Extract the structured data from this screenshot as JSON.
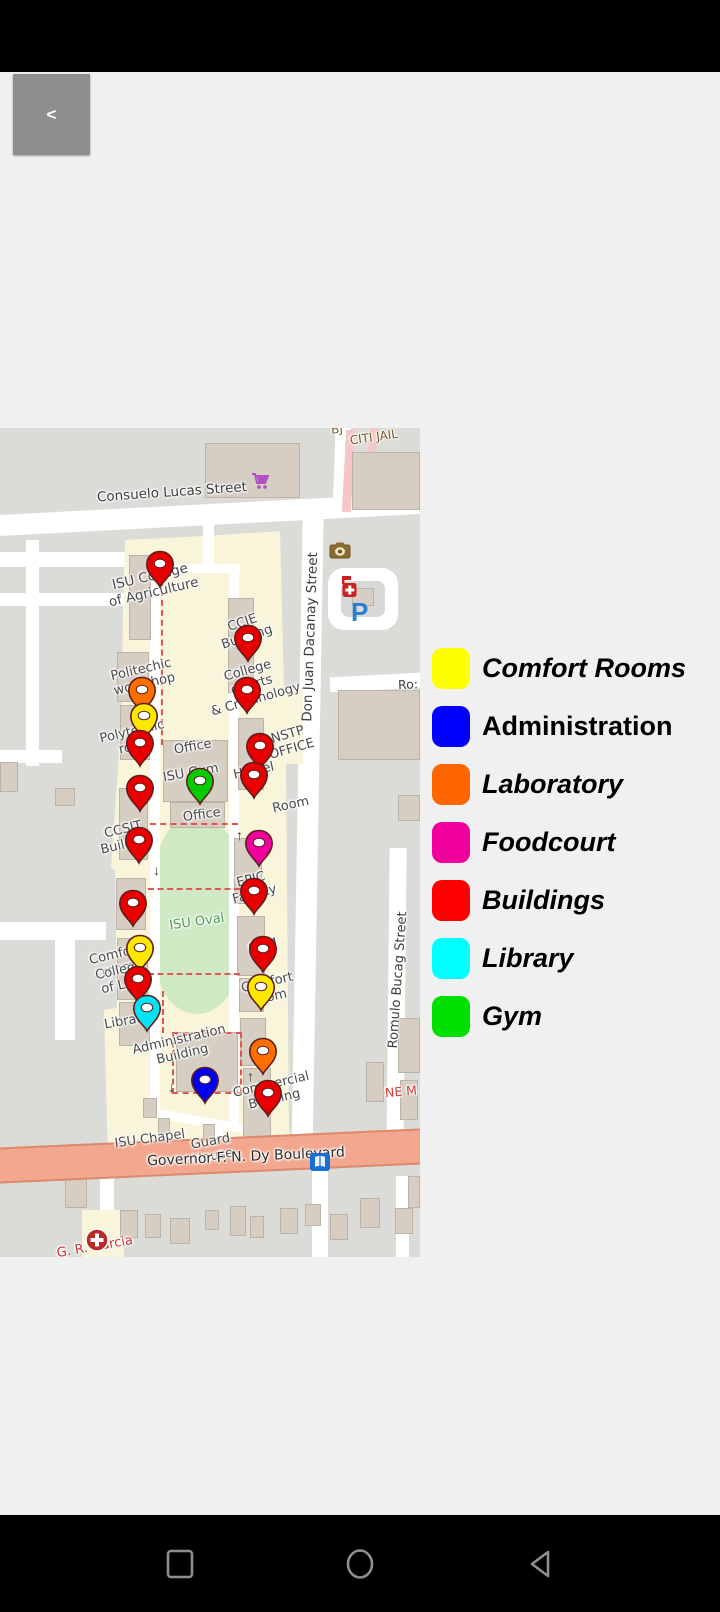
{
  "back_button": {
    "label": "<"
  },
  "legend": {
    "items": [
      {
        "label": "Comfort Rooms",
        "color": "#FFFF00",
        "italic": true,
        "category": "comfort-rooms"
      },
      {
        "label": "Administration",
        "color": "#0000FF",
        "italic": false,
        "category": "administration"
      },
      {
        "label": "Laboratory",
        "color": "#FF6600",
        "italic": true,
        "category": "laboratory"
      },
      {
        "label": "Foodcourt",
        "color": "#F0009C",
        "italic": true,
        "category": "foodcourt"
      },
      {
        "label": "Buildings",
        "color": "#FF0000",
        "italic": true,
        "category": "buildings"
      },
      {
        "label": "Library",
        "color": "#00FFFF",
        "italic": true,
        "category": "library"
      },
      {
        "label": "Gym",
        "color": "#00E000",
        "italic": true,
        "category": "gym"
      }
    ]
  },
  "map": {
    "marker_colors": {
      "building": "#E80000",
      "laboratory": "#FF6F00",
      "comfort-room": "#FFE800",
      "gym": "#00CC00",
      "library": "#00E5F5",
      "administration": "#0000F0",
      "foodcourt": "#F0009C"
    },
    "markers": [
      {
        "category": "building",
        "x": 160,
        "y": 138
      },
      {
        "category": "building",
        "x": 248,
        "y": 212
      },
      {
        "category": "building",
        "x": 247,
        "y": 264
      },
      {
        "category": "laboratory",
        "x": 142,
        "y": 264
      },
      {
        "category": "comfort-room",
        "x": 144,
        "y": 290
      },
      {
        "category": "building",
        "x": 140,
        "y": 317
      },
      {
        "category": "building",
        "x": 260,
        "y": 320
      },
      {
        "category": "building",
        "x": 254,
        "y": 349
      },
      {
        "category": "gym",
        "x": 200,
        "y": 355
      },
      {
        "category": "building",
        "x": 140,
        "y": 362
      },
      {
        "category": "building",
        "x": 139,
        "y": 414
      },
      {
        "category": "foodcourt",
        "x": 259,
        "y": 417
      },
      {
        "category": "building",
        "x": 254,
        "y": 465
      },
      {
        "category": "building",
        "x": 133,
        "y": 477
      },
      {
        "category": "comfort-room",
        "x": 140,
        "y": 522
      },
      {
        "category": "building",
        "x": 263,
        "y": 523
      },
      {
        "category": "building",
        "x": 138,
        "y": 553
      },
      {
        "category": "comfort-room",
        "x": 261,
        "y": 561
      },
      {
        "category": "library",
        "x": 147,
        "y": 582
      },
      {
        "category": "laboratory",
        "x": 263,
        "y": 625
      },
      {
        "category": "administration",
        "x": 205,
        "y": 654
      },
      {
        "category": "building",
        "x": 268,
        "y": 667
      }
    ],
    "labels": [
      {
        "id": "consuelo-lucas-street",
        "lines": [
          "Consuelo Lucas Street"
        ],
        "x": 172,
        "y": 65,
        "rot": -4,
        "size": 13.5,
        "color": "#3e3e3e"
      },
      {
        "id": "bj",
        "lines": [
          "BJ"
        ],
        "x": 337,
        "y": 2,
        "rot": -8,
        "size": 12,
        "color": "#7a5a28"
      },
      {
        "id": "citi-jail",
        "lines": [
          "CITI JAIL"
        ],
        "x": 374,
        "y": 10,
        "rot": -8,
        "size": 12,
        "color": "#7a5a28"
      },
      {
        "id": "don-juan-dacanay-street",
        "lines": [
          "Don Juan Dacanay Street"
        ],
        "x": 311,
        "y": 209,
        "rot": -88,
        "size": 13.5,
        "color": "#3e3e3e"
      },
      {
        "id": "ro",
        "lines": [
          "Ro:"
        ],
        "x": 408,
        "y": 257,
        "rot": -3,
        "size": 12.5,
        "color": "#3e3e3e"
      },
      {
        "id": "isu-college-of-agriculture",
        "lines": [
          "ISU College",
          "of Agriculture"
        ],
        "x": 152,
        "y": 157,
        "rot": -13,
        "size": 13.5,
        "color": "#4a4a4a"
      },
      {
        "id": "ccie-building",
        "lines": [
          "CCIE",
          "Building"
        ],
        "x": 245,
        "y": 203,
        "rot": -18,
        "size": 13,
        "color": "#4a4a4a"
      },
      {
        "id": "politechic-workshop",
        "lines": [
          "Politechic",
          "workshop"
        ],
        "x": 143,
        "y": 250,
        "rot": -13,
        "size": 13,
        "color": "#4a4a4a"
      },
      {
        "id": "polytechic-room",
        "lines": [
          "Polytechic",
          "room"
        ],
        "x": 134,
        "y": 312,
        "rot": -13,
        "size": 13,
        "color": "#4a4a4a"
      },
      {
        "id": "college-of-arts-criminology",
        "lines": [
          "College",
          "of Arts",
          "& Criminology"
        ],
        "x": 252,
        "y": 258,
        "rot": -16,
        "size": 13,
        "color": "#4a4a4a"
      },
      {
        "id": "nstp-office",
        "lines": [
          "NSTP",
          "OFFICE"
        ],
        "x": 290,
        "y": 315,
        "rot": -16,
        "size": 13,
        "color": "#4a4a4a"
      },
      {
        "id": "office-1",
        "lines": [
          "Office"
        ],
        "x": 193,
        "y": 320,
        "rot": -10,
        "size": 13,
        "color": "#4a4a4a"
      },
      {
        "id": "isu-gym",
        "lines": [
          "ISU Gym"
        ],
        "x": 191,
        "y": 346,
        "rot": -10,
        "size": 13,
        "color": "#4a4a4a"
      },
      {
        "id": "hostel",
        "lines": [
          "Hostel"
        ],
        "x": 254,
        "y": 344,
        "rot": -12,
        "size": 13,
        "color": "#4a4a4a"
      },
      {
        "id": "office-2",
        "lines": [
          "Office"
        ],
        "x": 202,
        "y": 388,
        "rot": -8,
        "size": 13,
        "color": "#4a4a4a"
      },
      {
        "id": "room",
        "lines": [
          "Room"
        ],
        "x": 291,
        "y": 378,
        "rot": -12,
        "size": 13,
        "color": "#4a4a4a"
      },
      {
        "id": "isu-oval",
        "lines": [
          "ISU Oval"
        ],
        "x": 197,
        "y": 495,
        "rot": -8,
        "size": 13,
        "color": "#4f9a55"
      },
      {
        "id": "epic-facility",
        "lines": [
          "EPIC",
          "Facility"
        ],
        "x": 253,
        "y": 460,
        "rot": -14,
        "size": 13,
        "color": "#4a4a4a"
      },
      {
        "id": "cbm",
        "lines": [
          "CBM"
        ],
        "x": 263,
        "y": 519,
        "rot": -12,
        "size": 13,
        "color": "#4a4a4a"
      },
      {
        "id": "comfort-room-left",
        "lines": [
          "Comfort",
          "room"
        ],
        "x": 117,
        "y": 535,
        "rot": -13,
        "size": 13,
        "color": "#4a4a4a"
      },
      {
        "id": "college-of-law",
        "lines": [
          "College",
          "of Law"
        ],
        "x": 121,
        "y": 551,
        "rot": -12,
        "size": 13,
        "color": "#4a4a4a"
      },
      {
        "id": "library-label",
        "lines": [
          "Library"
        ],
        "x": 127,
        "y": 594,
        "rot": -10,
        "size": 13,
        "color": "#4a4a4a"
      },
      {
        "id": "comfort-room-right",
        "lines": [
          "Comfort",
          "room"
        ],
        "x": 269,
        "y": 563,
        "rot": -13,
        "size": 13,
        "color": "#4a4a4a"
      },
      {
        "id": "ccsit-building",
        "lines": [
          "CCSIT",
          "Building"
        ],
        "x": 125,
        "y": 410,
        "rot": -13,
        "size": 13,
        "color": "#4a4a4a"
      },
      {
        "id": "administration-building",
        "lines": [
          "Administration",
          "Building"
        ],
        "x": 181,
        "y": 620,
        "rot": -13,
        "size": 13,
        "color": "#4a4a4a"
      },
      {
        "id": "commercial-building",
        "lines": [
          "Commercial",
          "Building"
        ],
        "x": 273,
        "y": 665,
        "rot": -13,
        "size": 13,
        "color": "#4a4a4a"
      },
      {
        "id": "isu-chapel",
        "lines": [
          "ISU Chapel"
        ],
        "x": 150,
        "y": 712,
        "rot": -8,
        "size": 13,
        "color": "#4a4a4a"
      },
      {
        "id": "guard-house",
        "lines": [
          "Guard",
          "House"
        ],
        "x": 212,
        "y": 722,
        "rot": -10,
        "size": 13,
        "color": "#4a4a4a"
      },
      {
        "id": "governor-dy-boulevard",
        "lines": [
          "Governor F. N. Dy Boulevard"
        ],
        "x": 246,
        "y": 729,
        "rot": -2.6,
        "size": 14,
        "color": "#2e2e2e"
      },
      {
        "id": "romulo-bucag-street",
        "lines": [
          "Romulo Bucag Street"
        ],
        "x": 399,
        "y": 552,
        "rot": -86,
        "size": 13,
        "color": "#3e3e3e"
      },
      {
        "id": "ne-m",
        "lines": [
          "NE M"
        ],
        "x": 401,
        "y": 664,
        "rot": -5,
        "size": 12.5,
        "color": "#d63a3a"
      },
      {
        "id": "g-r-garcia",
        "lines": [
          "G. R. Garcia"
        ],
        "x": 95,
        "y": 820,
        "rot": -10,
        "size": 13,
        "color": "#cc3333"
      }
    ],
    "icons": [
      {
        "name": "cart-icon",
        "x": 250,
        "y": 44
      },
      {
        "name": "camera-icon",
        "x": 329,
        "y": 114
      },
      {
        "name": "clinic-icon",
        "x": 340,
        "y": 148
      },
      {
        "name": "parking-icon",
        "x": 351,
        "y": 169
      },
      {
        "name": "book-icon",
        "x": 309,
        "y": 724
      },
      {
        "name": "hospital-icon",
        "x": 85,
        "y": 800
      },
      {
        "name": "arrow-down-icon",
        "x": 153,
        "y": 434
      },
      {
        "name": "arrow-up-icon",
        "x": 236,
        "y": 399
      },
      {
        "name": "arrow-up-icon",
        "x": 247,
        "y": 640
      },
      {
        "name": "arrow-down-icon",
        "x": 168,
        "y": 651
      }
    ]
  },
  "nav_bar": {
    "icons": [
      "recents-square",
      "home-circle",
      "back-triangle"
    ]
  }
}
